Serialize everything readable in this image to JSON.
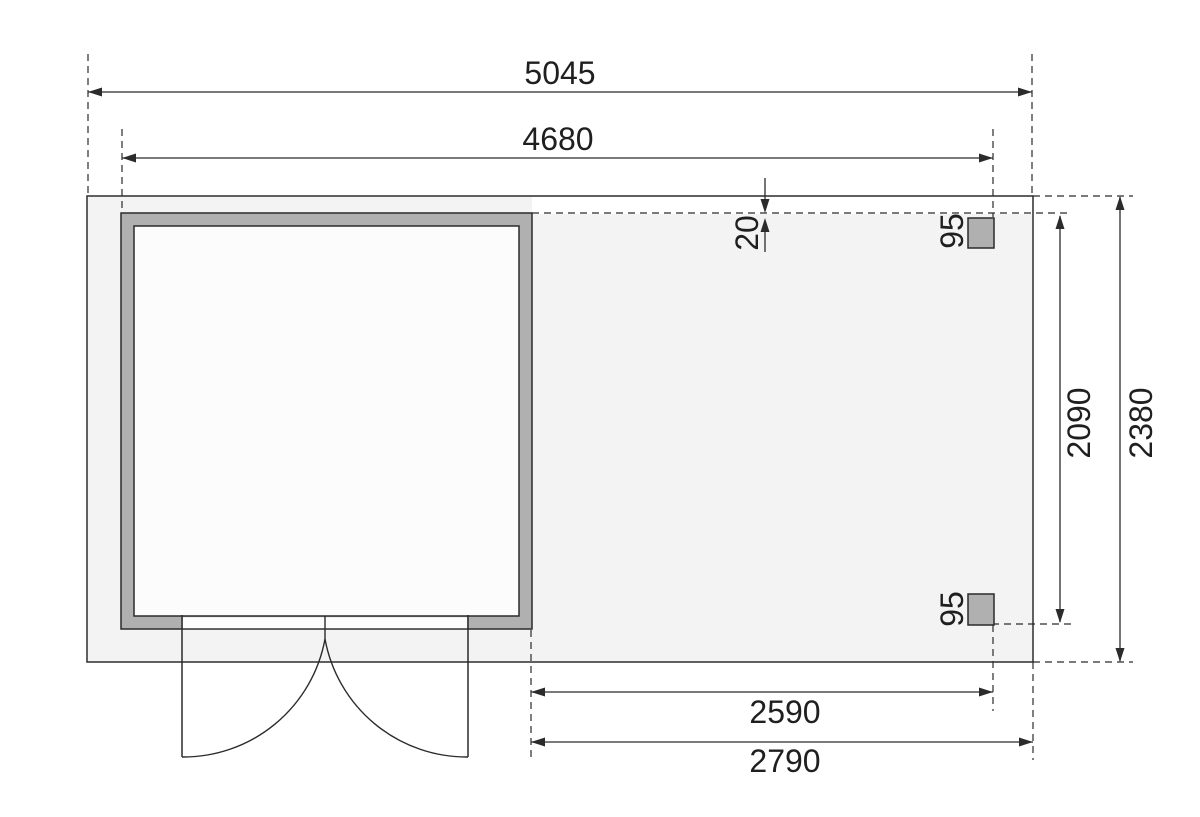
{
  "page": {
    "background": "#ffffff"
  },
  "plan": {
    "colors": {
      "line": "#2b2b2b",
      "wall_fill": "#b0b0b0",
      "post_fill": "#b0b0b0",
      "floor_fill": "#f3f3f3",
      "interior_fill": "#fcfcfc"
    },
    "dimensions": {
      "total_width": {
        "value": "5045",
        "orientation": "horizontal",
        "position": "top"
      },
      "shed_width": {
        "value": "4680",
        "orientation": "horizontal",
        "position": "top"
      },
      "total_depth": {
        "value": "2380",
        "orientation": "vertical",
        "position": "right"
      },
      "canopy_depth": {
        "value": "2090",
        "orientation": "vertical",
        "position": "right"
      },
      "post_span": {
        "value": "2590",
        "orientation": "horizontal",
        "position": "bottom"
      },
      "canopy_width": {
        "value": "2790",
        "orientation": "horizontal",
        "position": "bottom"
      },
      "roof_edge_offset": {
        "value": "20",
        "orientation": "vertical",
        "position": "top-middle"
      },
      "post_size_upper": {
        "value": "95",
        "orientation": "vertical",
        "position": "at-upper-post"
      },
      "post_size_lower": {
        "value": "95",
        "orientation": "vertical",
        "position": "at-lower-post"
      }
    }
  }
}
